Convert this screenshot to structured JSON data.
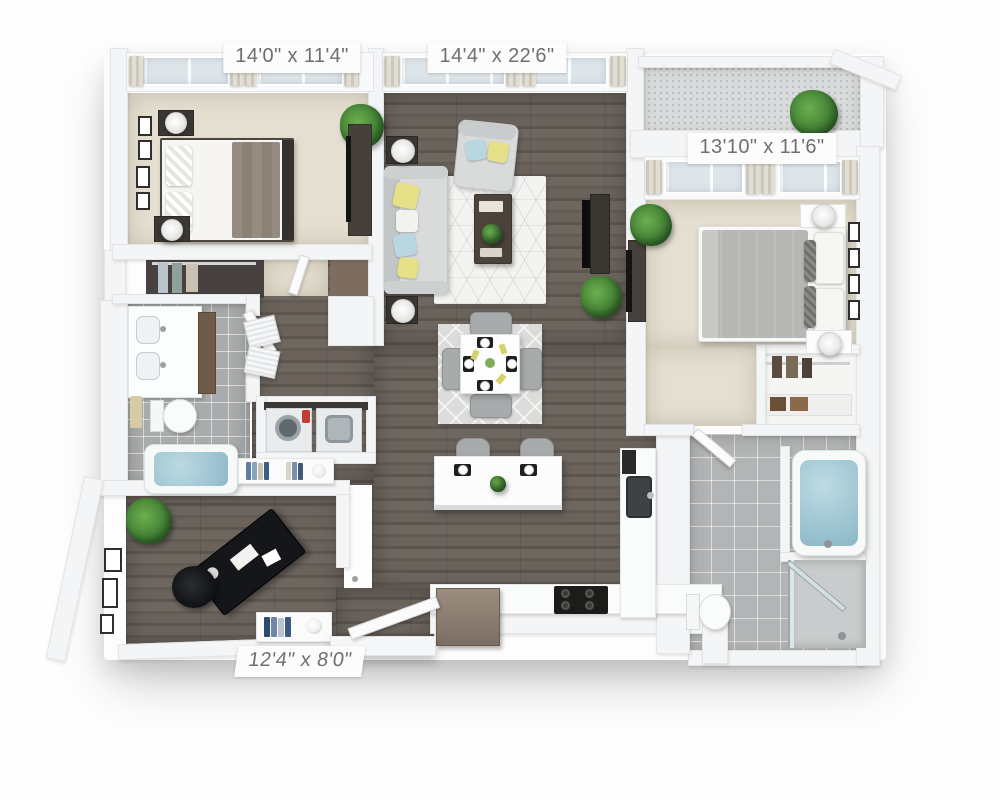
{
  "plan": {
    "title": "two-bedroom apartment 3d floor plan",
    "labels": {
      "bedroom1": "14'0\" x 11'4\"",
      "living": "14'4\" x 22'6\"",
      "bedroom2": "13'10\" x 11'6\"",
      "den": "12'4\" x 8'0\""
    },
    "colors": {
      "wall": "#f4f5f6",
      "wood_floor": "#645d56",
      "carpet": "#e5dfd1",
      "tile": "#a9abac",
      "water": "#a0c7d3",
      "accent_yellow": "#e6e089",
      "accent_blue": "#b9d7e1",
      "plant_green": "#3f7d33"
    }
  }
}
